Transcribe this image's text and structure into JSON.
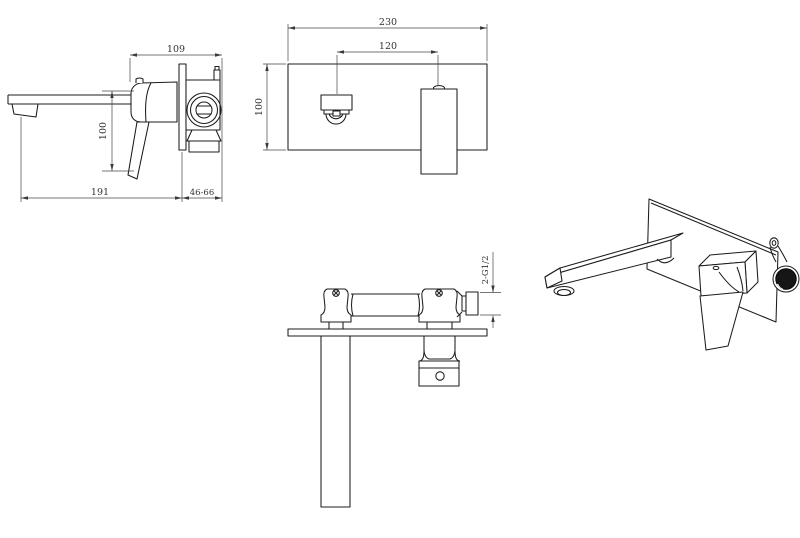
{
  "style": {
    "background": "#ffffff",
    "object_line": "#1c1c1c",
    "dimension_line": "#474747",
    "text_color": "#333333",
    "dark_fill": "#161616"
  },
  "views": {
    "side": {
      "dims": {
        "total_depth": "109",
        "drop_height": "100",
        "spout_reach": "191",
        "wall_depth_range": "46-66"
      }
    },
    "front": {
      "dims": {
        "plate_width": "230",
        "centre_distance": "120",
        "plate_height": "100"
      }
    },
    "top": {
      "dims": {
        "inlet_thread": "2-G1/2"
      }
    }
  }
}
